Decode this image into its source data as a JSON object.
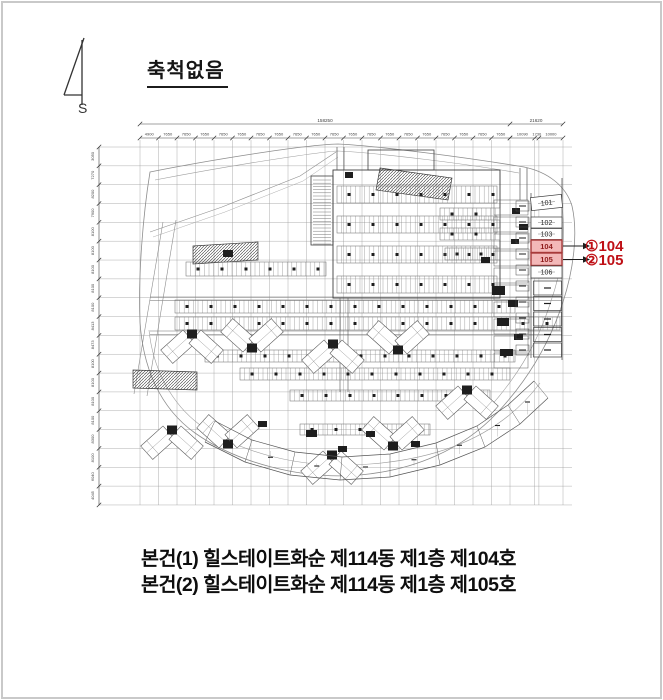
{
  "scale_note": {
    "text": "축척없음"
  },
  "north": {
    "label": "S"
  },
  "plan": {
    "dims": {
      "total_main": "158250",
      "total_right": "21620",
      "top_segments": [
        "4900",
        "7650",
        "7650",
        "7650",
        "7650",
        "7650",
        "7650",
        "7650",
        "7650",
        "7650",
        "7650",
        "7650",
        "7650",
        "7650",
        "7650",
        "7650",
        "7650",
        "7650",
        "7650",
        "7650"
      ],
      "top_right_segments": [
        "10090",
        "1730",
        "10000"
      ],
      "left_segments": [
        "3050",
        "7270",
        "8200",
        "7900",
        "8100",
        "8100",
        "8100",
        "8100",
        "8100",
        "8413",
        "8473",
        "8100",
        "8100",
        "8100",
        "8100",
        "8300",
        "8100",
        "6040",
        "4045"
      ]
    },
    "units": [
      {
        "label": "101",
        "highlight": false
      },
      {
        "label": "102",
        "highlight": false
      },
      {
        "label": "103",
        "highlight": false
      },
      {
        "label": "104",
        "highlight": true
      },
      {
        "label": "105",
        "highlight": true
      },
      {
        "label": "106",
        "highlight": false
      }
    ],
    "callouts": [
      {
        "text": "①104",
        "unit": "104"
      },
      {
        "text": "②105",
        "unit": "105"
      }
    ],
    "colors": {
      "highlight_fill": "#f3b8b8",
      "highlight_stroke": "#a83a3a",
      "highlight_text": "#8e1c1c",
      "callout": "#bf1016",
      "line": "#4a4a4a",
      "grid": "#9b9b9b",
      "dark": "#1e1e1e"
    }
  },
  "caption": {
    "lines": [
      "본건(1) 힐스테이트화순 제114동 제1층 제104호",
      "본건(2) 힐스테이트화순 제114동 제1층 제105호"
    ]
  }
}
